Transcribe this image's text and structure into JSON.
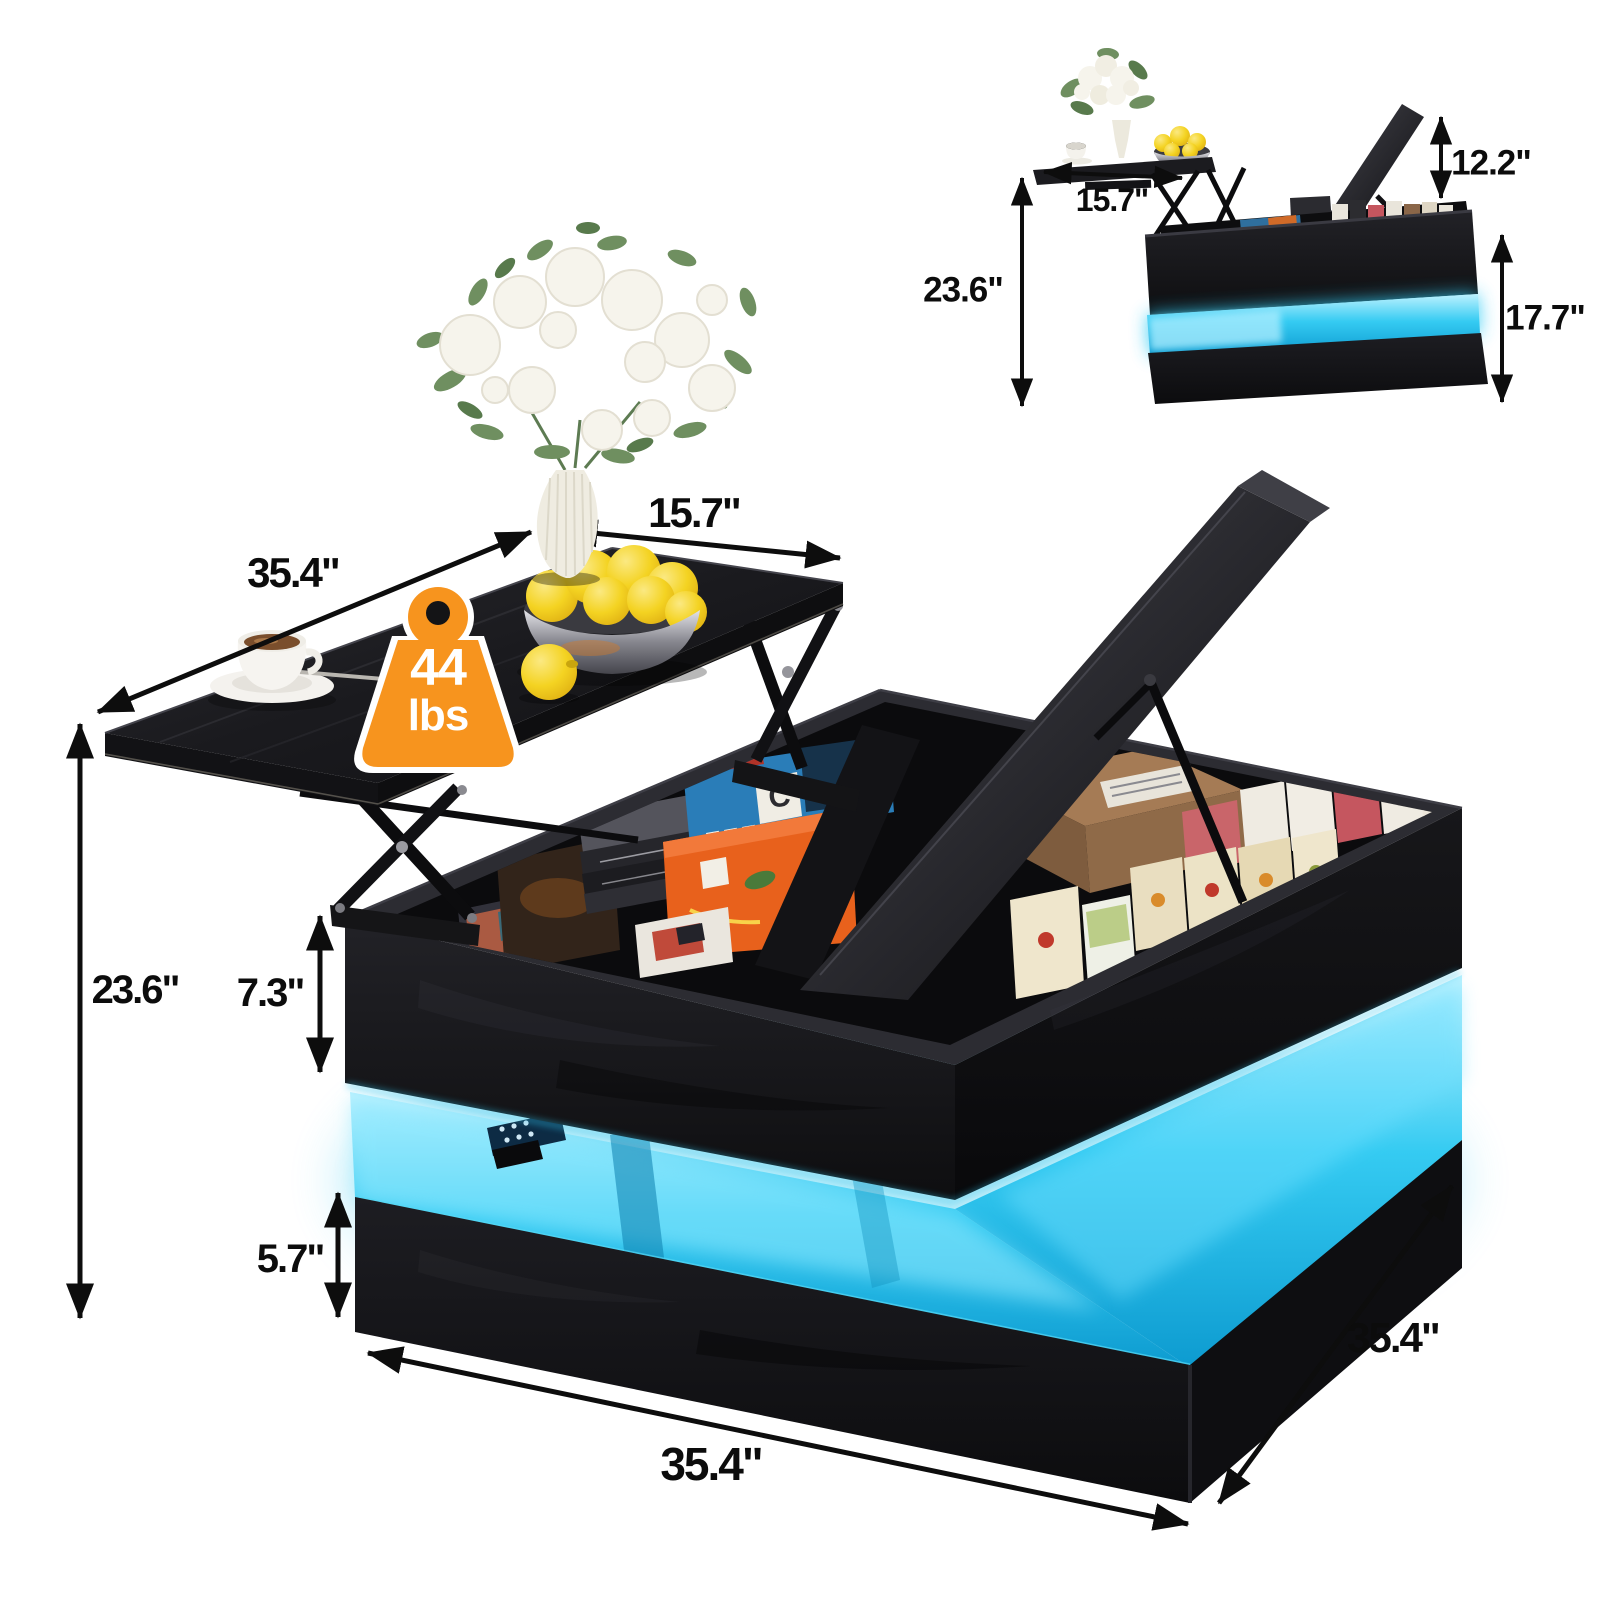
{
  "weight_badge": {
    "value": "44",
    "unit": "lbs",
    "badge_color": "#f7941e",
    "icon": "kettlebell-weight-icon"
  },
  "main_view": {
    "dimensions": {
      "top_length": "35.4\"",
      "top_width": "15.7\"",
      "overall_height": "23.6\"",
      "storage_depth": "7.3\"",
      "base_height": "5.7\"",
      "base_length": "35.4\"",
      "base_depth": "35.4\""
    }
  },
  "inset_view": {
    "dimensions": {
      "tabletop_width": "15.7\"",
      "lift_height": "12.2\"",
      "overall_height": "23.6\"",
      "table_height": "17.7\""
    }
  },
  "colors": {
    "led_glow": "#2cc6ef",
    "wood_black": "#17171a",
    "background": "#ffffff"
  }
}
